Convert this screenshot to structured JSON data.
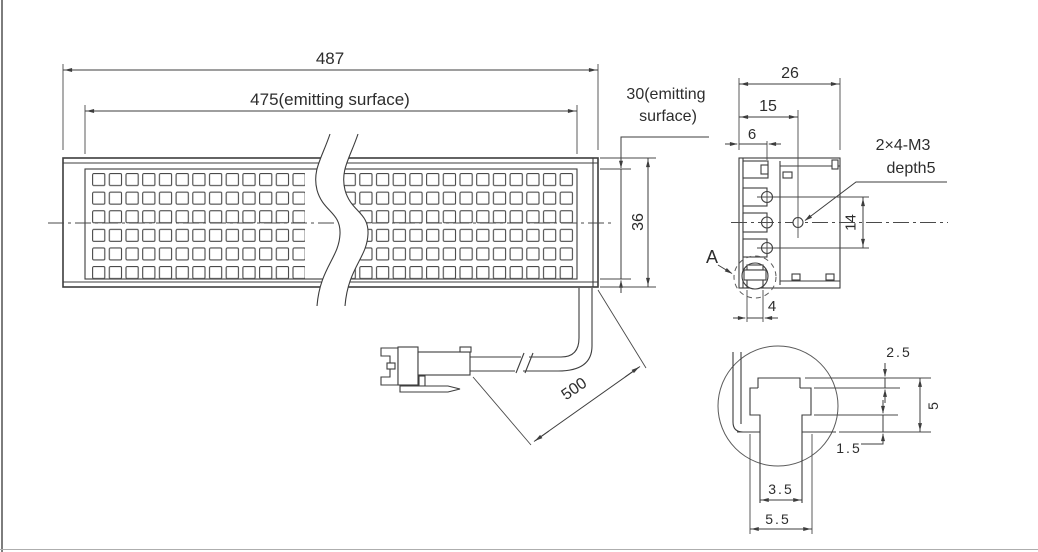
{
  "front_view": {
    "overall_length": "487",
    "emitting_length": "475(emitting surface)",
    "emitting_height_line1": "30(emitting",
    "emitting_height_line2": "surface)",
    "height": "36",
    "cable_length": "500"
  },
  "section_view": {
    "width": "26",
    "tap_offset": "15",
    "groove_offset": "6",
    "tap_note_line1": "2×4-M3",
    "tap_note_line2": "depth5",
    "tap_spacing": "14",
    "slot_width": "4",
    "detail_ref": "A"
  },
  "detail_view": {
    "recess_depth": "2.5",
    "slot_depth": "5",
    "lip_height": "1.5",
    "neck_width": "3.5",
    "cavity_width": "5.5"
  },
  "colors": {
    "line": "#3d3d3d",
    "text": "#2d2d2d",
    "background": "#ffffff",
    "frame": "#7d7d7d"
  }
}
